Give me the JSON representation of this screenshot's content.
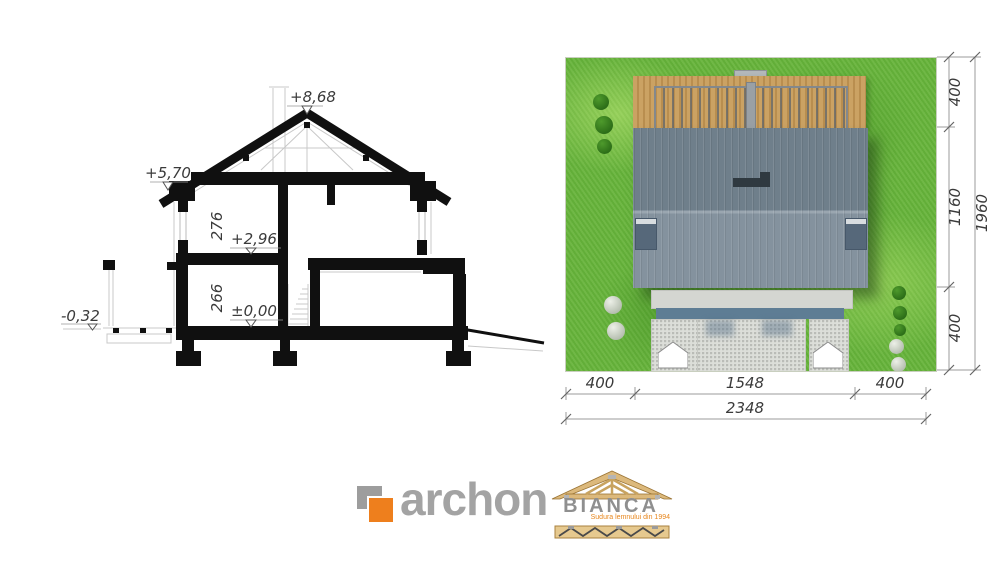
{
  "section_view": {
    "levels": {
      "ridge": "+8,68",
      "eave": "+5,70",
      "upper_floor": "+2,96",
      "ground_floor": "±0,00",
      "terrain": "-0,32"
    },
    "room_heights": {
      "upper": "276",
      "ground": "266"
    }
  },
  "site_plan": {
    "right_dimensions": {
      "segments": [
        "400",
        "1160",
        "400"
      ],
      "total": "1960"
    },
    "bottom_dimensions": {
      "segments": [
        "400",
        "1548",
        "400"
      ],
      "total": "2348"
    }
  },
  "branding": {
    "archon": {
      "name": "archon"
    },
    "bianca": {
      "name": "BIANCA",
      "tagline": "Sudura lemnului din 1994"
    }
  },
  "colors": {
    "grass": "#68b43c",
    "roof_upper": "#6f7f8b",
    "roof_lower": "#84929e",
    "deck_wood": "#c79d5d",
    "accent_orange": "#ee7f1d",
    "paving": "#dcded9",
    "ink": "#101010"
  }
}
